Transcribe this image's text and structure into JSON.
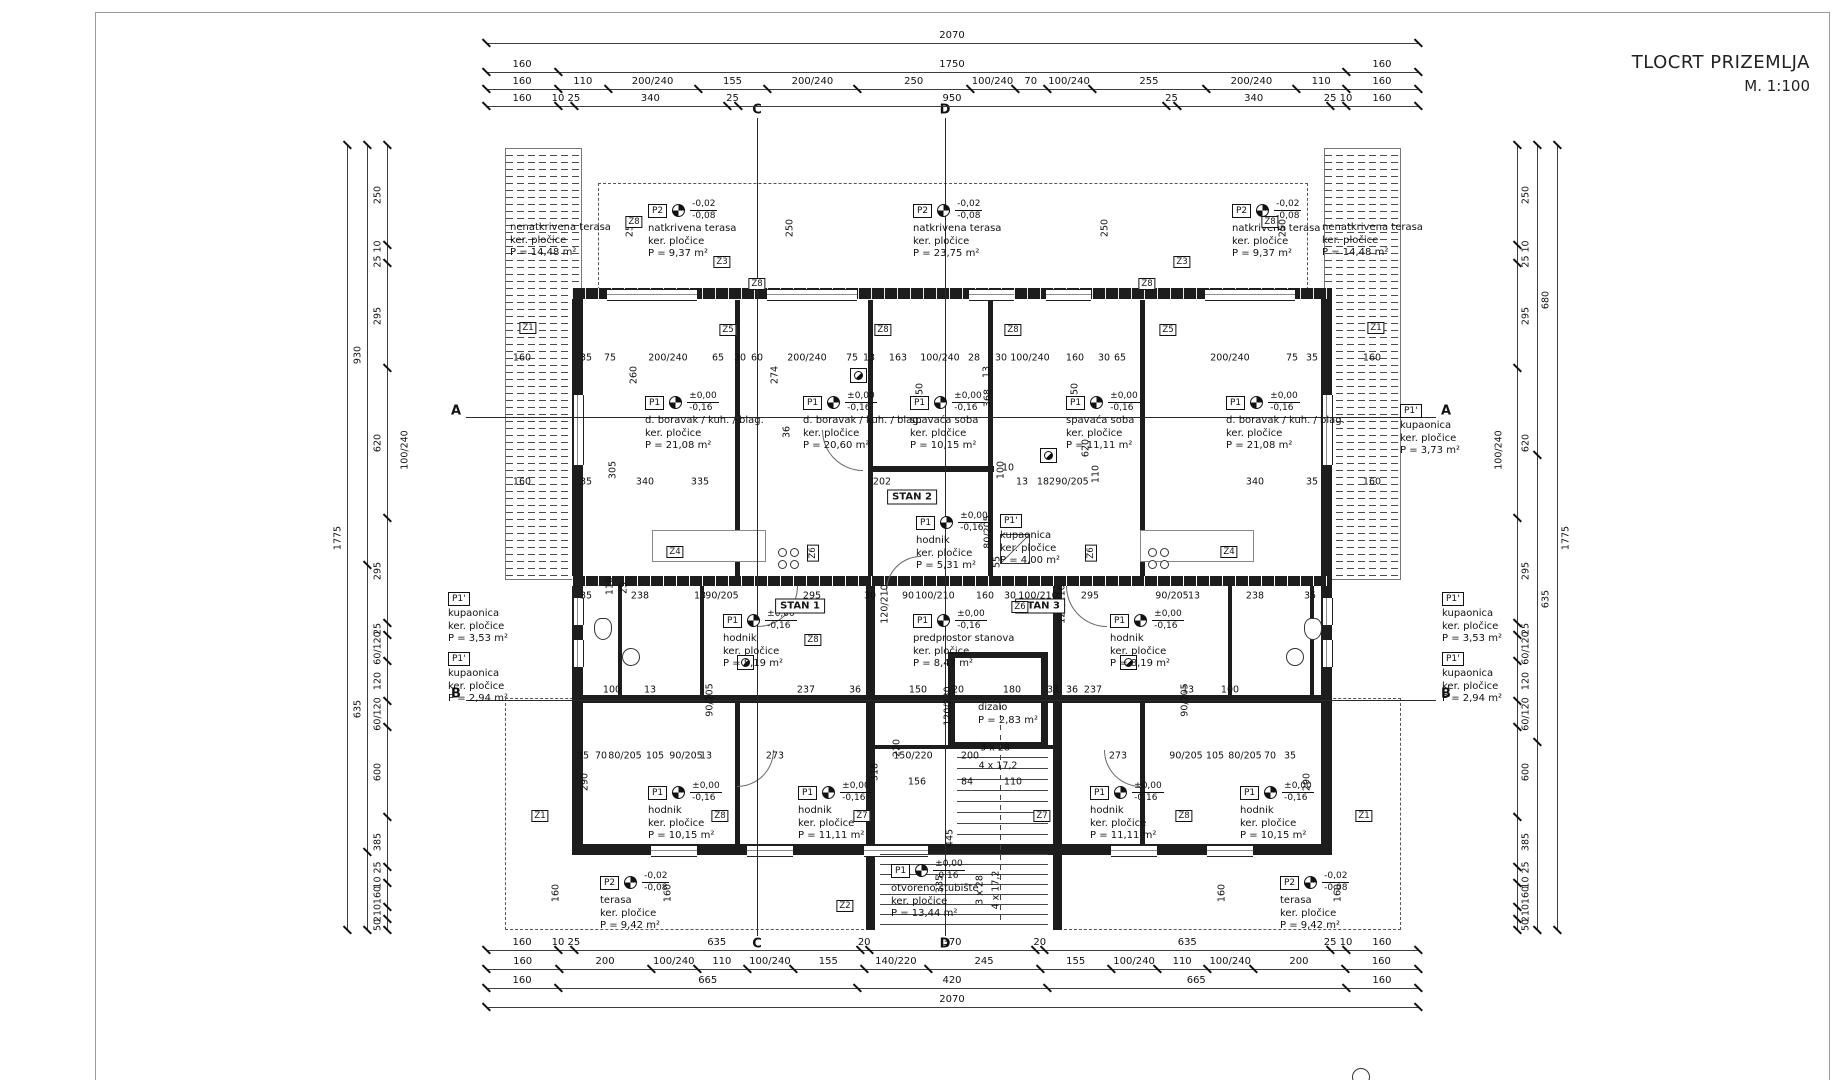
{
  "title": {
    "line1": "TLOCRT PRIZEMLJA",
    "line2": "M. 1:100"
  },
  "chains": {
    "top": [
      {
        "labels": [
          "2070"
        ],
        "w": [
          2070
        ]
      },
      {
        "labels": [
          "160",
          "1750",
          "160"
        ],
        "w": [
          160,
          1750,
          160
        ]
      },
      {
        "labels": [
          "160",
          "110",
          "200/240",
          "155",
          "200/240",
          "250",
          "100/240",
          "70",
          "100/240",
          "255",
          "200/240",
          "110",
          "160"
        ],
        "w": [
          160,
          110,
          200,
          155,
          200,
          250,
          100,
          70,
          100,
          255,
          200,
          110,
          160
        ]
      },
      {
        "labels": [
          "160",
          "10 25",
          "340",
          "25",
          "950",
          "25",
          "340",
          "25 10",
          "160"
        ],
        "w": [
          160,
          35,
          340,
          25,
          950,
          25,
          340,
          35,
          160
        ]
      }
    ],
    "bottom": [
      {
        "labels": [
          "160",
          "10 25",
          "635",
          "20",
          "370",
          "20",
          "635",
          "25 10",
          "160"
        ],
        "w": [
          160,
          35,
          635,
          20,
          370,
          20,
          635,
          35,
          160
        ]
      },
      {
        "labels": [
          "160",
          "200",
          "100/240",
          "110",
          "100/240",
          "155",
          "140/220",
          "245",
          "155",
          "100/240",
          "110",
          "100/240",
          "200",
          "160"
        ],
        "w": [
          160,
          200,
          100,
          110,
          100,
          155,
          140,
          245,
          155,
          100,
          110,
          100,
          200,
          160
        ]
      },
      {
        "labels": [
          "160",
          "665",
          "420",
          "665",
          "160"
        ],
        "w": [
          160,
          665,
          420,
          665,
          160
        ]
      },
      {
        "labels": [
          "2070"
        ],
        "w": [
          2070
        ]
      }
    ],
    "left_cols": [
      {
        "x": 347,
        "segs": [
          {
            "t": "1775",
            "h": 785
          }
        ]
      },
      {
        "x": 367,
        "segs": [
          {
            "t": "930",
            "h": 420
          },
          {
            "t": "635",
            "h": 287
          },
          {
            "t": "",
            "h": 78
          }
        ]
      },
      {
        "x": 387,
        "segs": [
          {
            "t": "250",
            "h": 100
          },
          {
            "t": "25 10",
            "h": 18
          },
          {
            "t": "295",
            "h": 105
          },
          {
            "t": "620",
            "h": 150
          },
          {
            "t": "295",
            "h": 105
          },
          {
            "t": "25",
            "h": 12
          },
          {
            "t": "60/120",
            "h": 26
          },
          {
            "t": "120",
            "h": 40
          },
          {
            "t": "60/120",
            "h": 26
          },
          {
            "t": "600",
            "h": 90
          },
          {
            "t": "385",
            "h": 50
          },
          {
            "t": "10 25",
            "h": 16
          },
          {
            "t": "160",
            "h": 24
          },
          {
            "t": "210",
            "h": 12
          },
          {
            "t": "50",
            "h": 11
          }
        ]
      }
    ],
    "right_cols": [
      {
        "x": 1517,
        "segs": [
          {
            "t": "250",
            "h": 100
          },
          {
            "t": "25 10",
            "h": 18
          },
          {
            "t": "295",
            "h": 105
          },
          {
            "t": "620",
            "h": 150
          },
          {
            "t": "295",
            "h": 105
          },
          {
            "t": "25",
            "h": 12
          },
          {
            "t": "60/120",
            "h": 26
          },
          {
            "t": "120",
            "h": 40
          },
          {
            "t": "60/120",
            "h": 26
          },
          {
            "t": "600",
            "h": 90
          },
          {
            "t": "385",
            "h": 50
          },
          {
            "t": "10 25",
            "h": 16
          },
          {
            "t": "160",
            "h": 24
          },
          {
            "t": "210",
            "h": 12
          },
          {
            "t": "50",
            "h": 11
          }
        ]
      },
      {
        "x": 1537,
        "segs": [
          {
            "t": "680",
            "h": 310
          },
          {
            "t": "635",
            "h": 287
          },
          {
            "t": "",
            "h": 188
          }
        ]
      },
      {
        "x": 1557,
        "segs": [
          {
            "t": "1775",
            "h": 785
          }
        ]
      }
    ],
    "side_floats": [
      {
        "t": "100/240",
        "x": 405,
        "y": 450
      },
      {
        "t": "100/240",
        "x": 1499,
        "y": 450
      }
    ]
  },
  "sections": {
    "horizontal": [
      {
        "label": "A",
        "y": 417
      },
      {
        "label": "B",
        "y": 700
      }
    ],
    "vertical": [
      {
        "label": "C",
        "x": 757
      },
      {
        "label": "D",
        "x": 945
      }
    ]
  },
  "stans": [
    {
      "t": "STAN 1",
      "x": 800,
      "y": 606
    },
    {
      "t": "STAN 2",
      "x": 912,
      "y": 497
    },
    {
      "t": "STAN 3",
      "x": 1040,
      "y": 606
    }
  ],
  "rooms": [
    {
      "x": 510,
      "y": 222,
      "lines": [
        "nenatkrivena terasa",
        "ker. pločice",
        "P = 14,48 m²"
      ]
    },
    {
      "x": 648,
      "y": 200,
      "tag": "P2",
      "lv": [
        "-0,02",
        "-0,08"
      ],
      "lines": [
        "natkrivena terasa",
        "ker. pločice",
        "P = 9,37 m²"
      ]
    },
    {
      "x": 913,
      "y": 200,
      "tag": "P2",
      "lv": [
        "-0,02",
        "-0,08"
      ],
      "lines": [
        "natkrivena terasa",
        "ker. pločice",
        "P = 23,75 m²"
      ]
    },
    {
      "x": 1232,
      "y": 200,
      "tag": "P2",
      "lv": [
        "-0,02",
        "-0,08"
      ],
      "lines": [
        "natkrivena terasa",
        "ker. pločice",
        "P = 9,37 m²"
      ]
    },
    {
      "x": 1322,
      "y": 222,
      "lines": [
        "nenatkrivena terasa",
        "ker. pločice",
        "P = 14,48 m²"
      ]
    },
    {
      "x": 645,
      "y": 392,
      "tag": "P1",
      "lv": [
        "±0,00",
        "-0,16"
      ],
      "lines": [
        "d. boravak / kuh. / blag.",
        "ker. pločice",
        "P = 21,08 m²"
      ]
    },
    {
      "x": 803,
      "y": 392,
      "tag": "P1",
      "lv": [
        "±0,00",
        "-0,16"
      ],
      "lines": [
        "d. boravak / kuh. / blag.",
        "ker. pločice",
        "P = 20,60 m²"
      ]
    },
    {
      "x": 910,
      "y": 392,
      "tag": "P1",
      "lv": [
        "±0,00",
        "-0,16"
      ],
      "lines": [
        "spavaća soba",
        "ker. pločice",
        "P = 10,15 m²"
      ]
    },
    {
      "x": 1066,
      "y": 392,
      "tag": "P1",
      "lv": [
        "±0,00",
        "-0,16"
      ],
      "lines": [
        "spavaća soba",
        "ker. pločice",
        "P = 11,11 m²"
      ]
    },
    {
      "x": 1226,
      "y": 392,
      "tag": "P1",
      "lv": [
        "±0,00",
        "-0,16"
      ],
      "lines": [
        "d. boravak / kuh. / blag.",
        "ker. pločice",
        "P = 21,08 m²"
      ]
    },
    {
      "x": 1400,
      "y": 404,
      "tag": "P1'",
      "lines": [
        "kupaonica",
        "ker. pločice",
        "P = 3,73 m²"
      ]
    },
    {
      "x": 916,
      "y": 512,
      "tag": "P1",
      "lv": [
        "±0,00",
        "-0,16"
      ],
      "lines": [
        "hodnik",
        "ker. pločice",
        "P = 5,31 m²"
      ]
    },
    {
      "x": 1000,
      "y": 514,
      "tag": "P1'",
      "lines": [
        "kupaonica",
        "ker. pločice",
        "P = 4,00 m²"
      ]
    },
    {
      "x": 448,
      "y": 592,
      "tag": "P1'",
      "lines": [
        "kupaonica",
        "ker. pločice",
        "P = 3,53 m²"
      ]
    },
    {
      "x": 448,
      "y": 652,
      "tag": "P1'",
      "lines": [
        "kupaonica",
        "ker. pločice",
        "P = 2,94 m²"
      ]
    },
    {
      "x": 1442,
      "y": 592,
      "tag": "P1'",
      "lines": [
        "kupaonica",
        "ker. pločice",
        "P = 3,53 m²"
      ]
    },
    {
      "x": 1442,
      "y": 652,
      "tag": "P1'",
      "lines": [
        "kupaonica",
        "ker. pločice",
        "P = 2,94 m²"
      ]
    },
    {
      "x": 723,
      "y": 610,
      "tag": "P1",
      "lv": [
        "±0,00",
        "-0,16"
      ],
      "lines": [
        "hodnik",
        "ker. pločice",
        "P = 8,19 m²"
      ]
    },
    {
      "x": 913,
      "y": 610,
      "tag": "P1",
      "lv": [
        "±0,00",
        "-0,16"
      ],
      "lines": [
        "predprostor stanova",
        "ker. pločice",
        "P = 8,47 m²"
      ]
    },
    {
      "x": 1110,
      "y": 610,
      "tag": "P1",
      "lv": [
        "±0,00",
        "-0,16"
      ],
      "lines": [
        "hodnik",
        "ker. pločice",
        "P = 8,19 m²"
      ]
    },
    {
      "x": 648,
      "y": 782,
      "tag": "P1",
      "lv": [
        "±0,00",
        "-0,16"
      ],
      "lines": [
        "hodnik",
        "ker. pločice",
        "P = 10,15 m²"
      ]
    },
    {
      "x": 798,
      "y": 782,
      "tag": "P1",
      "lv": [
        "±0,00",
        "-0,16"
      ],
      "lines": [
        "hodnik",
        "ker. pločice",
        "P = 11,11 m²"
      ]
    },
    {
      "x": 1090,
      "y": 782,
      "tag": "P1",
      "lv": [
        "±0,00",
        "-0,16"
      ],
      "lines": [
        "hodnik",
        "ker. pločice",
        "P = 11,11 m²"
      ]
    },
    {
      "x": 1240,
      "y": 782,
      "tag": "P1",
      "lv": [
        "±0,00",
        "-0,16"
      ],
      "lines": [
        "hodnik",
        "ker. pločice",
        "P = 10,15 m²"
      ]
    },
    {
      "x": 891,
      "y": 860,
      "tag": "P1",
      "lv": [
        "±0,00",
        "-0,16"
      ],
      "lines": [
        "otvoreno stubište",
        "ker. pločice",
        "P = 13,44 m²"
      ]
    },
    {
      "x": 600,
      "y": 872,
      "tag": "P2",
      "lv": [
        "-0,02",
        "-0,08"
      ],
      "lines": [
        "terasa",
        "ker. pločice",
        "P = 9,42 m²"
      ]
    },
    {
      "x": 1280,
      "y": 872,
      "tag": "P2",
      "lv": [
        "-0,02",
        "-0,08"
      ],
      "lines": [
        "terasa",
        "ker. pločice",
        "P = 9,42 m²"
      ]
    },
    {
      "x": 978,
      "y": 702,
      "lines": [
        "dizalo",
        "P = 2,83 m²"
      ]
    }
  ],
  "zlabels": [
    {
      "t": "Z1",
      "x": 528,
      "y": 328
    },
    {
      "t": "Z1",
      "x": 1376,
      "y": 328
    },
    {
      "t": "Z3",
      "x": 722,
      "y": 262
    },
    {
      "t": "Z3",
      "x": 1182,
      "y": 262
    },
    {
      "t": "Z8",
      "x": 634,
      "y": 222
    },
    {
      "t": "Z8",
      "x": 1270,
      "y": 222
    },
    {
      "t": "Z8",
      "x": 757,
      "y": 284
    },
    {
      "t": "Z8",
      "x": 1147,
      "y": 284
    },
    {
      "t": "Z5",
      "x": 728,
      "y": 330
    },
    {
      "t": "Z5",
      "x": 1168,
      "y": 330
    },
    {
      "t": "Z8",
      "x": 883,
      "y": 330
    },
    {
      "t": "Z8",
      "x": 1013,
      "y": 330
    },
    {
      "t": "Z4",
      "x": 675,
      "y": 552
    },
    {
      "t": "Z4",
      "x": 1229,
      "y": 552
    },
    {
      "t": "Z6",
      "x": 813,
      "y": 553,
      "v": 1
    },
    {
      "t": "Z6",
      "x": 1091,
      "y": 553,
      "v": 1
    },
    {
      "t": "Z8",
      "x": 813,
      "y": 640
    },
    {
      "t": "Z6",
      "x": 1020,
      "y": 607
    },
    {
      "t": "Z1",
      "x": 540,
      "y": 816
    },
    {
      "t": "Z1",
      "x": 1364,
      "y": 816
    },
    {
      "t": "Z8",
      "x": 720,
      "y": 816
    },
    {
      "t": "Z8",
      "x": 1184,
      "y": 816
    },
    {
      "t": "Z7",
      "x": 862,
      "y": 816
    },
    {
      "t": "Z7",
      "x": 1042,
      "y": 816
    },
    {
      "t": "Z2",
      "x": 845,
      "y": 906
    }
  ],
  "dims": [
    [
      "250",
      630,
      228,
      1
    ],
    [
      "250",
      790,
      228,
      1
    ],
    [
      "250",
      1105,
      228,
      1
    ],
    [
      "250",
      1283,
      228,
      1
    ],
    [
      "160",
      522,
      358
    ],
    [
      "35",
      586,
      358
    ],
    [
      "75",
      610,
      358
    ],
    [
      "260",
      634,
      375,
      1
    ],
    [
      "200/240",
      668,
      358
    ],
    [
      "65",
      718,
      358
    ],
    [
      "30",
      740,
      358
    ],
    [
      "60",
      757,
      358
    ],
    [
      "274",
      775,
      375,
      1
    ],
    [
      "200/240",
      807,
      358
    ],
    [
      "75",
      852,
      358
    ],
    [
      "13",
      869,
      358
    ],
    [
      "163",
      898,
      358
    ],
    [
      "100/240",
      940,
      358
    ],
    [
      "28",
      974,
      358
    ],
    [
      "13",
      987,
      372,
      1
    ],
    [
      "30",
      1001,
      358
    ],
    [
      "100/240",
      1030,
      358
    ],
    [
      "160",
      1075,
      358
    ],
    [
      "30",
      1104,
      358
    ],
    [
      "65",
      1120,
      358
    ],
    [
      "200/240",
      1230,
      358
    ],
    [
      "75",
      1292,
      358
    ],
    [
      "35",
      1312,
      358
    ],
    [
      "160",
      1372,
      358
    ],
    [
      "350",
      920,
      392,
      1
    ],
    [
      "368",
      988,
      398,
      1
    ],
    [
      "350",
      1075,
      392,
      1
    ],
    [
      "305",
      613,
      470,
      1
    ],
    [
      "36",
      787,
      432,
      1
    ],
    [
      "620",
      1086,
      448,
      1
    ],
    [
      "100",
      1001,
      470,
      1
    ],
    [
      "160",
      522,
      482
    ],
    [
      "35",
      586,
      482
    ],
    [
      "340",
      645,
      482
    ],
    [
      "335",
      700,
      482
    ],
    [
      "202",
      882,
      482
    ],
    [
      "10",
      1008,
      468
    ],
    [
      "13",
      1022,
      482
    ],
    [
      "182",
      1046,
      482
    ],
    [
      "90/205",
      1072,
      482
    ],
    [
      "110",
      1096,
      474,
      1
    ],
    [
      "340",
      1255,
      482
    ],
    [
      "35",
      1312,
      482
    ],
    [
      "160",
      1372,
      482
    ],
    [
      "80/205",
      988,
      532,
      1
    ],
    [
      "55",
      997,
      562,
      1
    ],
    [
      "110",
      610,
      586,
      1
    ],
    [
      "25",
      624,
      588,
      1
    ],
    [
      "35",
      586,
      596
    ],
    [
      "238",
      640,
      596
    ],
    [
      "13",
      700,
      596
    ],
    [
      "90/205",
      722,
      596
    ],
    [
      "295",
      812,
      596
    ],
    [
      "30",
      870,
      596
    ],
    [
      "120/210",
      885,
      604,
      1
    ],
    [
      "90",
      908,
      596
    ],
    [
      "100/210",
      935,
      596
    ],
    [
      "160",
      985,
      596
    ],
    [
      "30",
      1010,
      596
    ],
    [
      "100/210",
      1038,
      596
    ],
    [
      "120/210",
      1062,
      604,
      1
    ],
    [
      "295",
      1090,
      596
    ],
    [
      "90/205",
      1172,
      596
    ],
    [
      "13",
      1194,
      596
    ],
    [
      "238",
      1255,
      596
    ],
    [
      "35",
      1310,
      596
    ],
    [
      "100",
      612,
      690
    ],
    [
      "13",
      650,
      690
    ],
    [
      "90/205",
      710,
      700,
      1
    ],
    [
      "237",
      806,
      690
    ],
    [
      "36",
      855,
      690
    ],
    [
      "150",
      918,
      690
    ],
    [
      "20",
      958,
      690
    ],
    [
      "180",
      1012,
      690
    ],
    [
      "33",
      1053,
      690
    ],
    [
      "36",
      1072,
      690
    ],
    [
      "237",
      1093,
      690
    ],
    [
      "13",
      1188,
      690
    ],
    [
      "100",
      1230,
      690
    ],
    [
      "90/205",
      1185,
      700,
      1
    ],
    [
      "220",
      897,
      748,
      1
    ],
    [
      "120/230",
      948,
      706,
      1
    ],
    [
      "35",
      583,
      756
    ],
    [
      "70",
      601,
      756
    ],
    [
      "80/205",
      625,
      756
    ],
    [
      "105",
      655,
      756
    ],
    [
      "90/205",
      686,
      756
    ],
    [
      "13",
      706,
      756
    ],
    [
      "273",
      775,
      756
    ],
    [
      "318",
      875,
      772,
      1
    ],
    [
      "150/220",
      913,
      756
    ],
    [
      "200",
      970,
      756
    ],
    [
      "3 x 28",
      995,
      748
    ],
    [
      "4 x 17,2",
      998,
      766
    ],
    [
      "273",
      1118,
      756
    ],
    [
      "90/205",
      1186,
      756
    ],
    [
      "105",
      1215,
      756
    ],
    [
      "80/205",
      1245,
      756
    ],
    [
      "70",
      1270,
      756
    ],
    [
      "35",
      1290,
      756
    ],
    [
      "290",
      585,
      782,
      1
    ],
    [
      "156",
      917,
      782
    ],
    [
      "84",
      967,
      782
    ],
    [
      "110",
      1013,
      782
    ],
    [
      "445",
      950,
      838,
      1
    ],
    [
      "290",
      1307,
      782,
      1
    ],
    [
      "335",
      940,
      884,
      1
    ],
    [
      "3 x 28",
      980,
      890,
      1
    ],
    [
      "4 x 17,2",
      996,
      890,
      1
    ],
    [
      "160",
      556,
      893,
      1
    ],
    [
      "160",
      668,
      893,
      1
    ],
    [
      "160",
      1222,
      893,
      1
    ],
    [
      "160",
      1338,
      893,
      1
    ]
  ]
}
